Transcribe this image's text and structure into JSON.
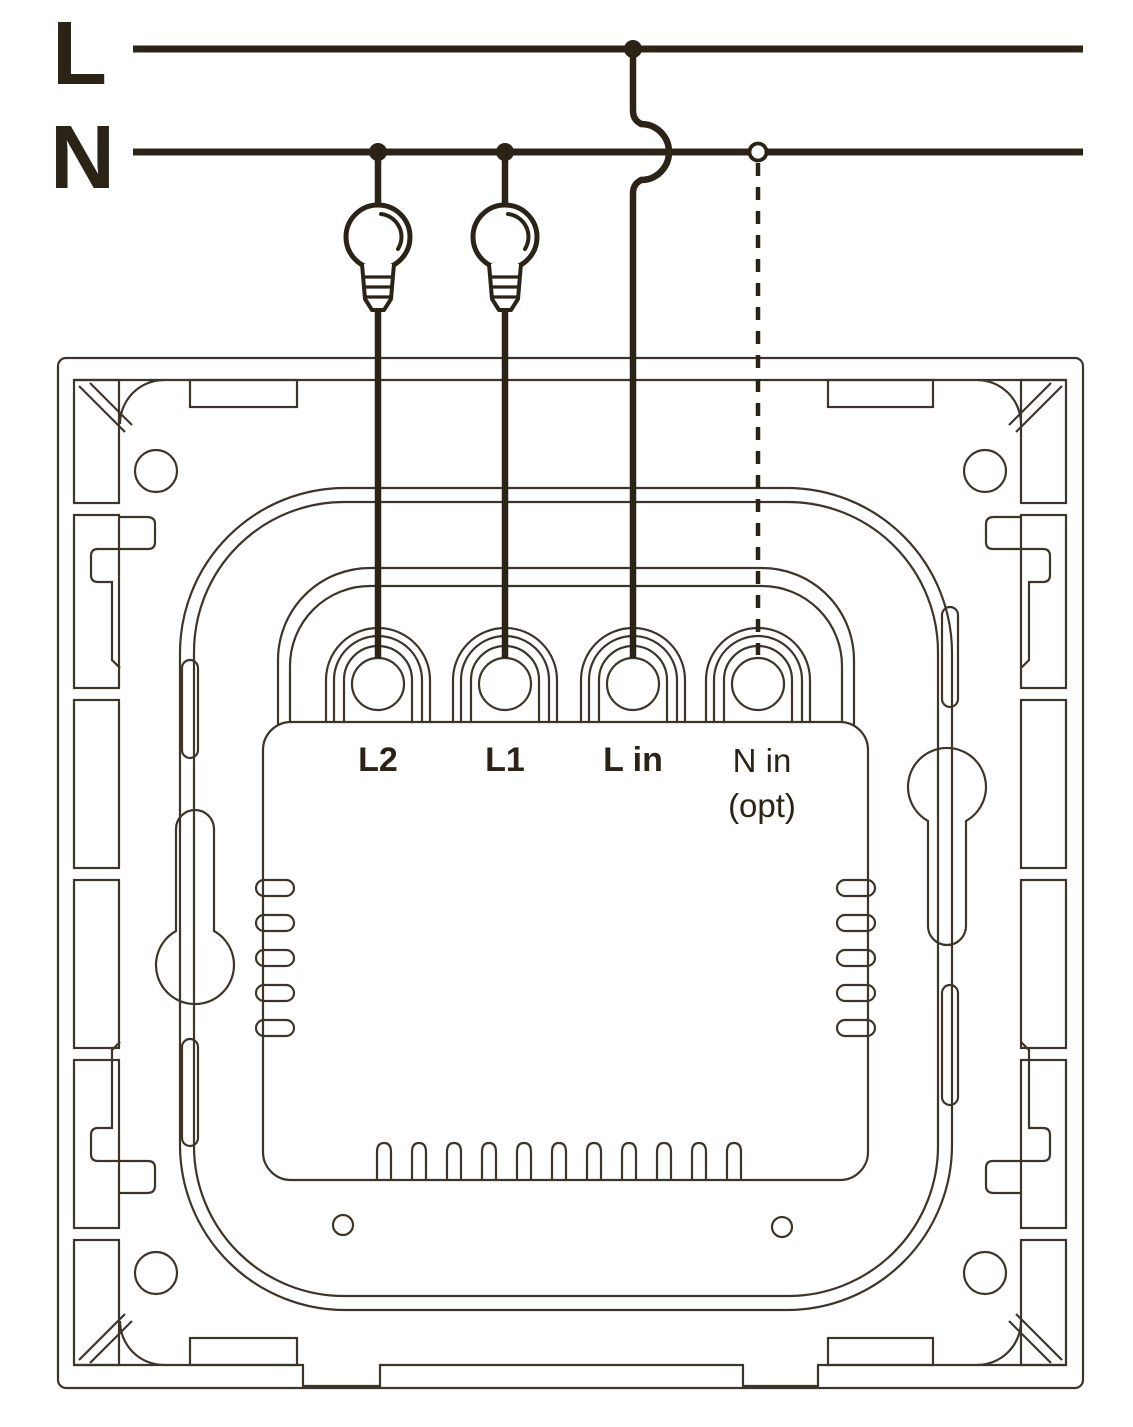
{
  "power_rails": {
    "live_label": "L",
    "neutral_label": "N"
  },
  "terminals": {
    "t1": "L2",
    "t2": "L1",
    "t3": "L in",
    "t4_line1": "N in",
    "t4_line2": "(opt)"
  },
  "wiring": {
    "lamp_count": 2,
    "solid_junction_dots": 3,
    "open_connector_dots": 1,
    "neutral_in_is_dashed_optional": true
  },
  "colors": {
    "ink": "#2b2416",
    "thin_line": "#3e352a",
    "background": "#ffffff"
  }
}
